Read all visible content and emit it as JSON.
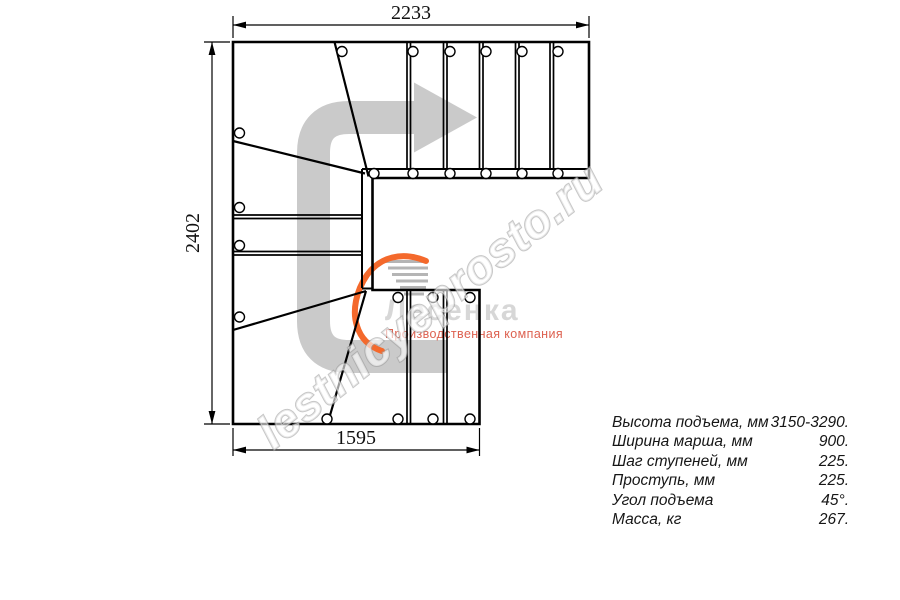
{
  "drawing": {
    "title": "U-shaped winder staircase plan (top view)",
    "dimensions": {
      "top": "2233",
      "left": "2402",
      "bottom": "1595"
    }
  },
  "watermark_text": "lestnicyeprosto.ru",
  "logo": {
    "brand": "Лесенка",
    "tagline": "Производственная компания"
  },
  "specs": [
    {
      "label": "Высота подъема, мм",
      "value": "3150-3290."
    },
    {
      "label": "Ширина марша, мм",
      "value": "900."
    },
    {
      "label": "Шаг ступеней, мм",
      "value": "225."
    },
    {
      "label": "Проступь, мм",
      "value": "225."
    },
    {
      "label": "Угол подъема",
      "value": "45°."
    },
    {
      "label": "Масса, кг",
      "value": "267."
    }
  ],
  "colors": {
    "line": "#000000",
    "arrow": "#cacaca",
    "logo_accent": "#f4692c",
    "logo_steps": "#b5b5b5",
    "logo_text": "#d7d7d7",
    "logo_tagline": "#dd6150"
  }
}
